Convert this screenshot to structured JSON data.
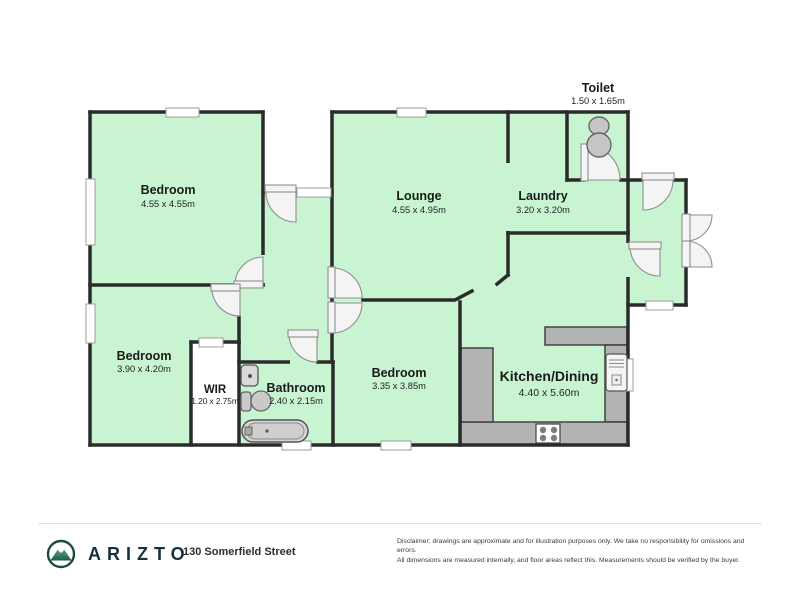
{
  "plan": {
    "rooms": [
      {
        "id": "bedroom-1",
        "name": "Bedroom",
        "dims": "4.55 x 4.55m"
      },
      {
        "id": "lounge",
        "name": "Lounge",
        "dims": "4.55 x 4.95m"
      },
      {
        "id": "laundry",
        "name": "Laundry",
        "dims": "3.20 x 3.20m"
      },
      {
        "id": "toilet",
        "name": "Toilet",
        "dims": "1.50 x 1.65m"
      },
      {
        "id": "bedroom-2",
        "name": "Bedroom",
        "dims": "3.90 x 4.20m"
      },
      {
        "id": "wir",
        "name": "WIR",
        "dims": "1.20 x 2.75m"
      },
      {
        "id": "bathroom",
        "name": "Bathroom",
        "dims": "2.40 x 2.15m"
      },
      {
        "id": "bedroom-3",
        "name": "Bedroom",
        "dims": "3.35 x 3.85m"
      },
      {
        "id": "kitchen-dining",
        "name": "Kitchen/Dining",
        "dims": "4.40 x 5.60m"
      }
    ],
    "colors": {
      "room_fill": "#c8f4d2",
      "wall": "#2b2b2b",
      "counter": "#b3b3b3",
      "fixture": "#c9c9c9",
      "brand_teal": "#1d4a43"
    }
  },
  "footer": {
    "brand": "ARIZTO",
    "address": "130 Somerfield Street",
    "disclaimer_line1": "Disclaimer: drawings are approximate and for illustration purposes only. We take no responsibility for omissions and errors.",
    "disclaimer_line2": "All dimensions are measured internally, and floor areas reflect this. Measurements should be verified by the buyer."
  }
}
